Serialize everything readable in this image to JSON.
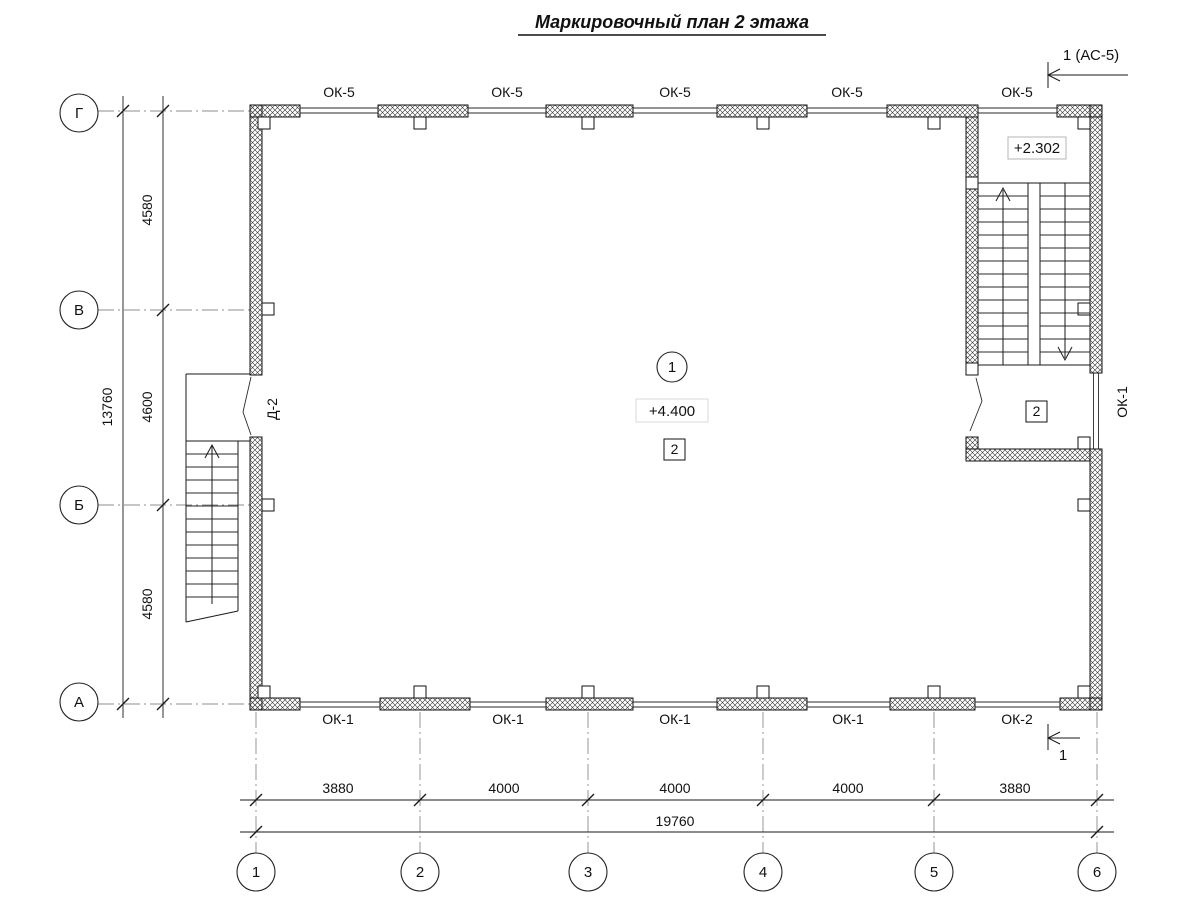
{
  "title": "Маркировочный план 2 этажа",
  "marks": {
    "section_top": "1 (АС-5)",
    "section_bottom": "1"
  },
  "axes": {
    "rows": [
      "Г",
      "В",
      "Б",
      "А"
    ],
    "cols": [
      "1",
      "2",
      "3",
      "4",
      "5",
      "6"
    ]
  },
  "dims": {
    "left": [
      "4580",
      "4600",
      "4580"
    ],
    "left_total": "13760",
    "bottom": [
      "3880",
      "4000",
      "4000",
      "4000",
      "3880"
    ],
    "bottom_total": "19760"
  },
  "windows": {
    "top": [
      "ОК-5",
      "ОК-5",
      "ОК-5",
      "ОК-5",
      "ОК-5"
    ],
    "bottom": [
      "ОК-1",
      "ОК-1",
      "ОК-1",
      "ОК-1",
      "ОК-2"
    ],
    "right": "ОК-1"
  },
  "door": "Д-2",
  "room": {
    "number": "1",
    "elevation": "+4.400",
    "zone": "2"
  },
  "stair": {
    "elevation": "+2.302",
    "zone": "2"
  }
}
